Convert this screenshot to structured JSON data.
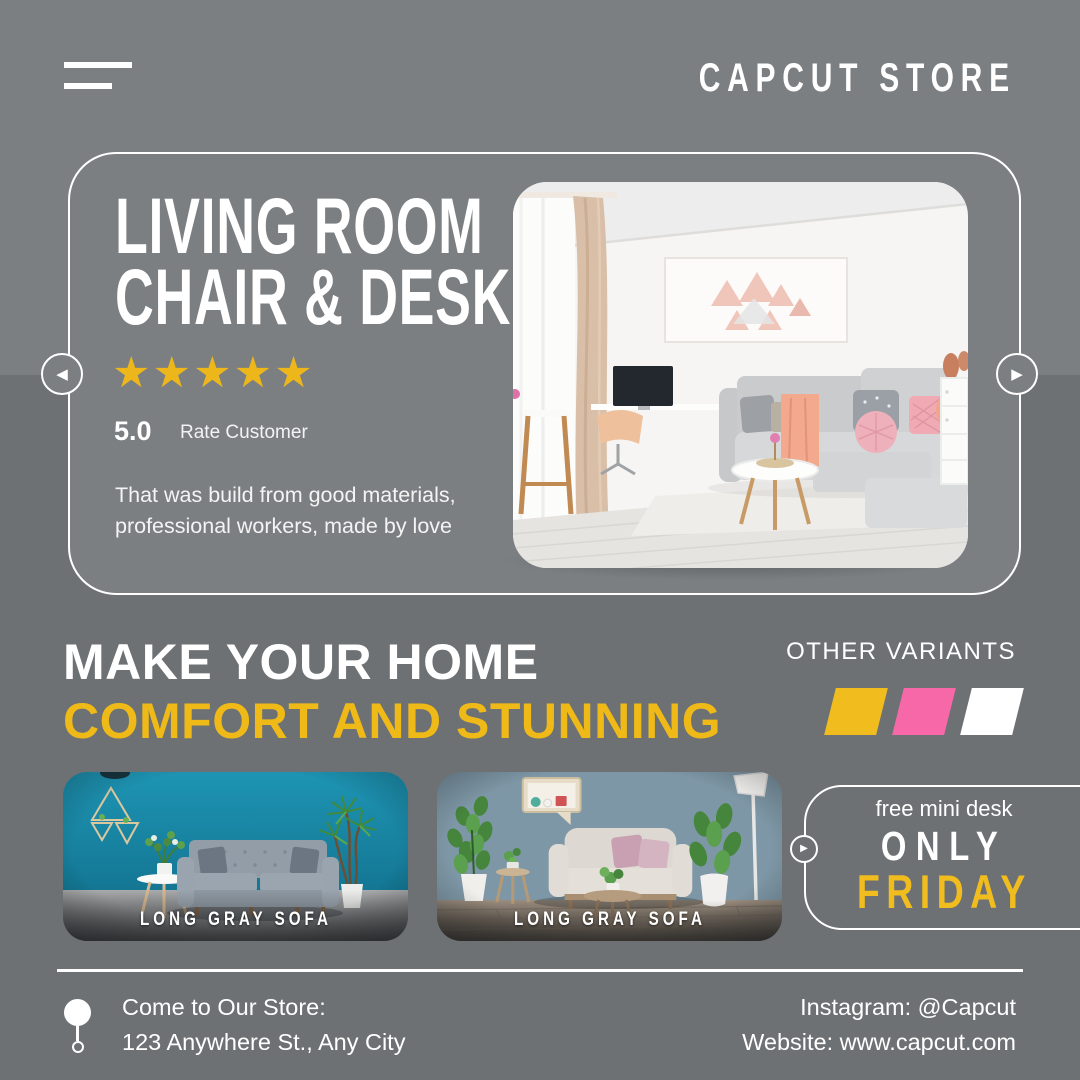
{
  "header": {
    "brand": "CAPCUT STORE",
    "menu_icon": "hamburger"
  },
  "hero": {
    "title_line1": "LIVING ROOM",
    "title_line2": "CHAIR & DESK",
    "stars": "★★★★★",
    "rating_value": "5.0",
    "rating_label": "Rate Customer",
    "description_line1": "That was build from good materials,",
    "description_line2": "professional workers, made by love"
  },
  "carousel": {
    "prev_icon": "◀",
    "next_icon": "▶"
  },
  "promo": {
    "headline_line1": "MAKE YOUR HOME",
    "headline_line2": "COMFORT AND STUNNING",
    "variants_label": "OTHER VARIANTS",
    "variant_colors": [
      "#F0BC1E",
      "#F768A8",
      "#FFFFFF"
    ]
  },
  "products": [
    {
      "label": "LONG GRAY SOFA"
    },
    {
      "label": "LONG GRAY SOFA"
    }
  ],
  "offer": {
    "tagline": "free mini desk",
    "line1": "ONLY",
    "line2": "FRIDAY",
    "arrow_icon": "▶"
  },
  "footer": {
    "store_line1": "Come to Our Store:",
    "store_line2": "123 Anywhere St., Any City",
    "instagram": "Instagram: @Capcut",
    "website": "Website: www.capcut.com"
  },
  "colors": {
    "bg_top": "#7B7F82",
    "bg_bottom": "#6D7174",
    "accent_yellow": "#EFBA18",
    "accent_pink": "#F768A8",
    "star_gold": "#EDB71C"
  }
}
